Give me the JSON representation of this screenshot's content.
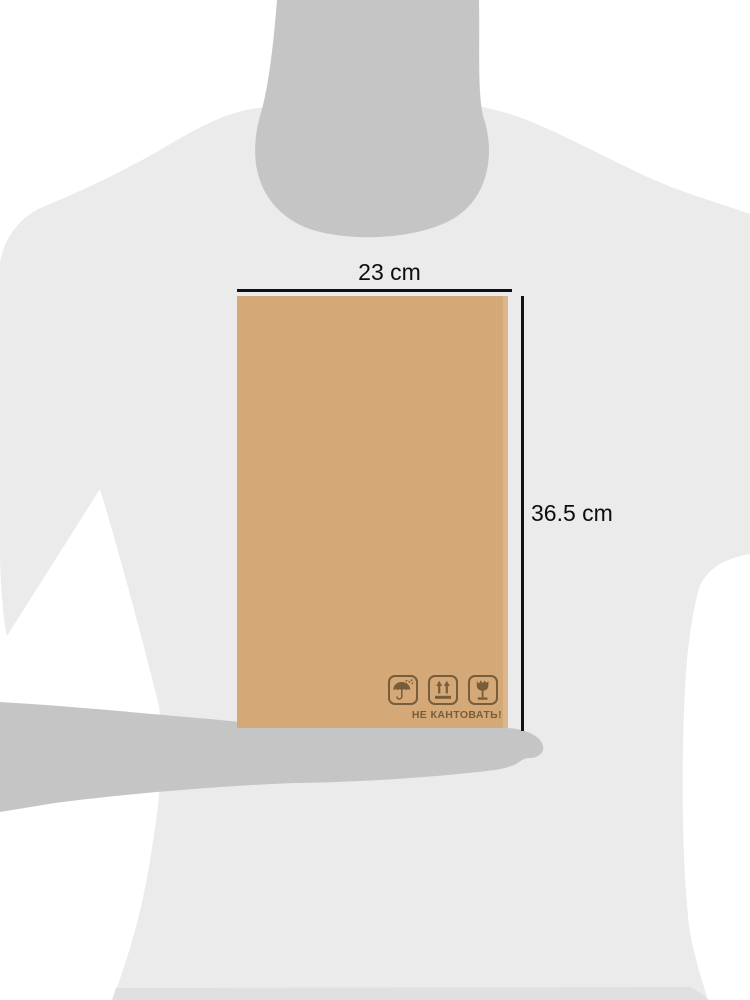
{
  "annotation": {
    "width_label": "23 cm",
    "height_label": "36.5 cm"
  },
  "package": {
    "marking_text": "НЕ КАНТОВАТЬ!",
    "icons": [
      {
        "name": "keep-dry-icon",
        "symbol": "umbrella-with-raindrops"
      },
      {
        "name": "this-side-up-icon",
        "symbol": "two-arrows-up-over-bar"
      },
      {
        "name": "fragile-icon",
        "symbol": "broken-glass"
      }
    ]
  },
  "colors": {
    "background": "#ffffff",
    "shirt": "#ebebeb",
    "skin": "#c5c5c5",
    "bottom_band": "#e0e0e0",
    "box": "#d5a977",
    "marking": "#6e5738",
    "dimension": "#111111"
  }
}
